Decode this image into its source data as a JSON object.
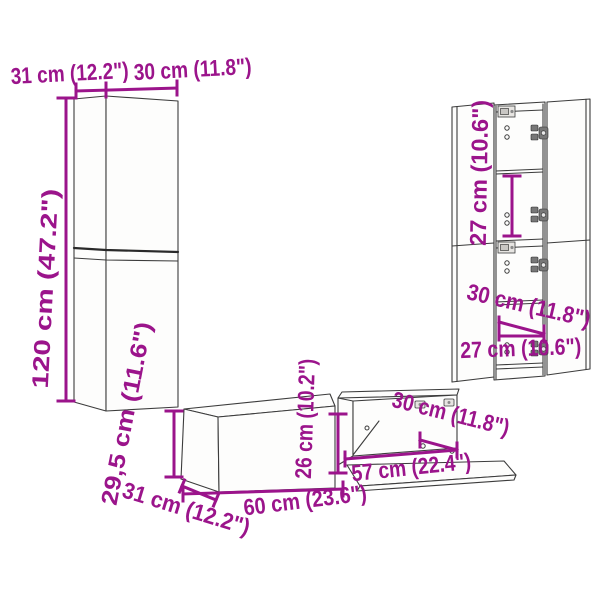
{
  "style": {
    "dimension_color": "#9b148b",
    "outline_color": "#3c3c3c",
    "background_color": "#ffffff"
  },
  "icons": {
    "hinge": "hinge-icon",
    "wall_bracket": "wall-bracket-icon",
    "flap_hinge": "flap-hinge-icon"
  },
  "labels": {
    "tall_cabinet_depth": "31 cm (12.2\")",
    "tall_cabinet_width": "30 cm (11.8\")",
    "tall_cabinet_height": "120 cm (47.2\")",
    "wall_cabinet_compartment_height": "27 cm (10.6\")",
    "wall_cabinet_depth": "30 cm (11.8\")",
    "wall_cabinet_width": "27 cm (10.6\")",
    "tv_bench_height": "29,5 cm (11.6\")",
    "tv_bench_depth": "31 cm (12.2\")",
    "tv_bench_width": "60 cm (23.6\")",
    "tv_bench_open_height": "26 cm (10.2\")",
    "tv_bench_open_depth": "30 cm (11.8\")",
    "tv_bench_open_width": "57 cm (22.4\")"
  }
}
